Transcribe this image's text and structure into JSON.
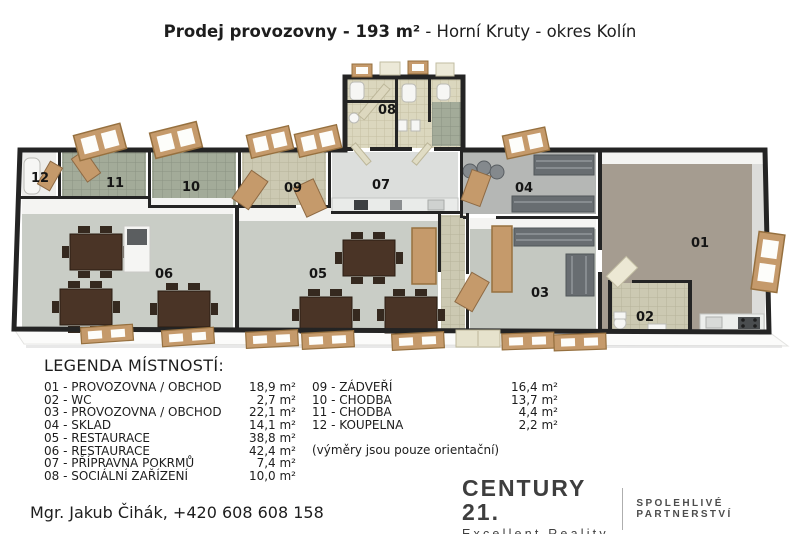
{
  "title": {
    "bold": "Prodej provozovny - 193 m²",
    "rest": " - Horní Kruty - okres Kolín"
  },
  "floorplan": {
    "labels": [
      "01",
      "02",
      "03",
      "04",
      "05",
      "06",
      "07",
      "08",
      "09",
      "10",
      "11",
      "12"
    ]
  },
  "legend": {
    "title": "LEGENDA MÍSTNOSTÍ:",
    "col1": [
      {
        "label": "01 - PROVOZOVNA / OBCHOD",
        "area": "18,9 m²"
      },
      {
        "label": "02 - WC",
        "area": "2,7 m²"
      },
      {
        "label": "03 - PROVOZOVNA / OBCHOD",
        "area": "22,1 m²"
      },
      {
        "label": "04 - SKLAD",
        "area": "14,1 m²"
      },
      {
        "label": "05 - RESTAURACE",
        "area": "38,8 m²"
      },
      {
        "label": "06 - RESTAURACE",
        "area": "42,4 m²"
      },
      {
        "label": "07 - PŘÍPRAVNA POKRMŮ",
        "area": "7,4 m²"
      },
      {
        "label": "08 - SOCIÁLNÍ ZAŘÍZENÍ",
        "area": "10,0 m²"
      }
    ],
    "col2": [
      {
        "label": "09 - ZÁDVEŘÍ",
        "area": "16,4 m²"
      },
      {
        "label": "10 - CHODBA",
        "area": "13,7 m²"
      },
      {
        "label": "11 - CHODBA",
        "area": "4,4 m²"
      },
      {
        "label": "12 - KOUPELNA",
        "area": "2,2 m²"
      }
    ],
    "note": "(výměry jsou pouze orientační)"
  },
  "agent": "Mgr. Jakub Čihák, +420 608 608 158",
  "logo": {
    "brand": "CENTURY 21.",
    "subtitle": "Excellent Reality",
    "tagline": "SPOLEHLIVÉ PARTNERSTVÍ"
  },
  "colors": {
    "wall": "#242424",
    "wood": "#c59a6b",
    "table": "#4a3426",
    "floor_tan": "#a59c90",
    "floor_gray": "#c9cdc6",
    "tile_green": "#a3ab99",
    "tile_beige": "#ccc9b2",
    "logo_gray": "#3e3e3e"
  }
}
